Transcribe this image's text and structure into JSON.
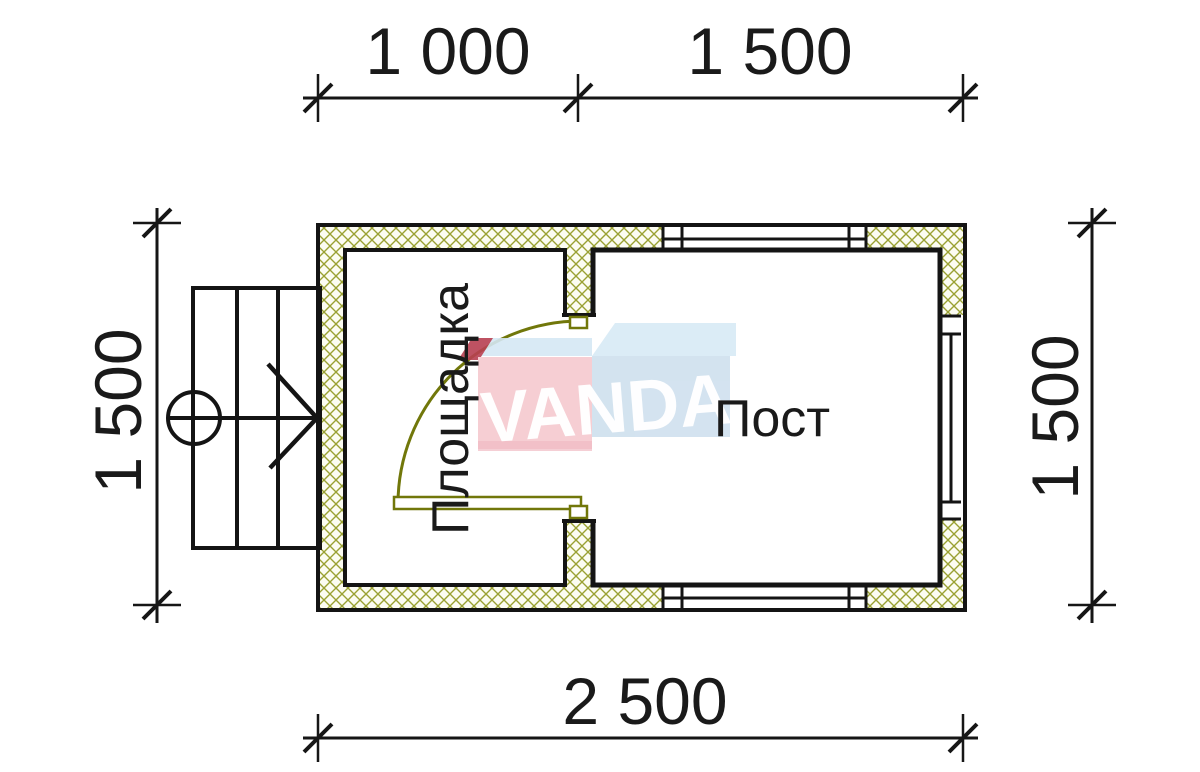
{
  "drawing": {
    "type": "architectural floor plan",
    "dimensions": {
      "top_segment_left": "1 000",
      "top_segment_right": "1 500",
      "left_height": "1 500",
      "right_height": "1 500",
      "bottom_width": "2 500"
    },
    "rooms": {
      "left_label": "Площадка",
      "right_label": "Пост"
    },
    "watermark": {
      "text": "VANDA"
    },
    "colors": {
      "wall_line": "#141414",
      "hatch_line": "#9aa133",
      "hatch_bg": "#fcfcf2",
      "door_olive": "#71770a",
      "logo_pink": "#f6c9cf",
      "logo_light_blue": "#d8eaf6",
      "logo_blue_front": "#cfe0ee",
      "logo_dark_red": "#b84052"
    }
  }
}
